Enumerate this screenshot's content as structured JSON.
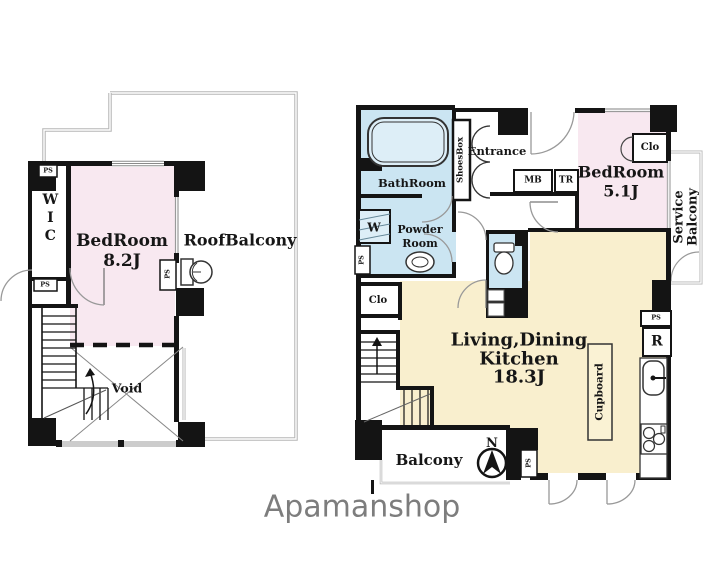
{
  "logo_text": "Apamanshop",
  "colors": {
    "wall": "#141414",
    "bedroom_pink": "#f8e8f0",
    "ldk_cream": "#f9efce",
    "wet_area_blue": "#cbe5f2",
    "balcony_outline_gray": "#b5b5b5",
    "logo_gray": "#7d7d7d"
  },
  "upper": {
    "ps_a": "PS",
    "wic": "WIC",
    "ps_b": "PS",
    "bedroom": "BedRoom",
    "bedroom_size": "8.2J",
    "roof_balcony": "RoofBalcony",
    "ps_c": "PS",
    "void": "Void"
  },
  "main": {
    "bathroom": "BathRoom",
    "shoes_box": "ShoesBox",
    "entrance": "Entrance",
    "mb": "MB",
    "tr": "TR",
    "bedroom": "BedRoom",
    "bedroom_size": "5.1J",
    "closet_a": "Clo",
    "service_line1": "Service",
    "service_line2": "Balcony",
    "washer": "W",
    "powder_line1": "Powder",
    "powder_line2": "Room",
    "ps_a": "PS",
    "closet_b": "Clo",
    "ldk_line1": "Living,Dining",
    "ldk_line2": "Kitchen",
    "ldk_size": "18.3J",
    "cupboard": "Cupboard",
    "ps_b": "PS",
    "fridge": "R",
    "balcony": "Balcony",
    "north": "N",
    "ps_c": "PS"
  }
}
